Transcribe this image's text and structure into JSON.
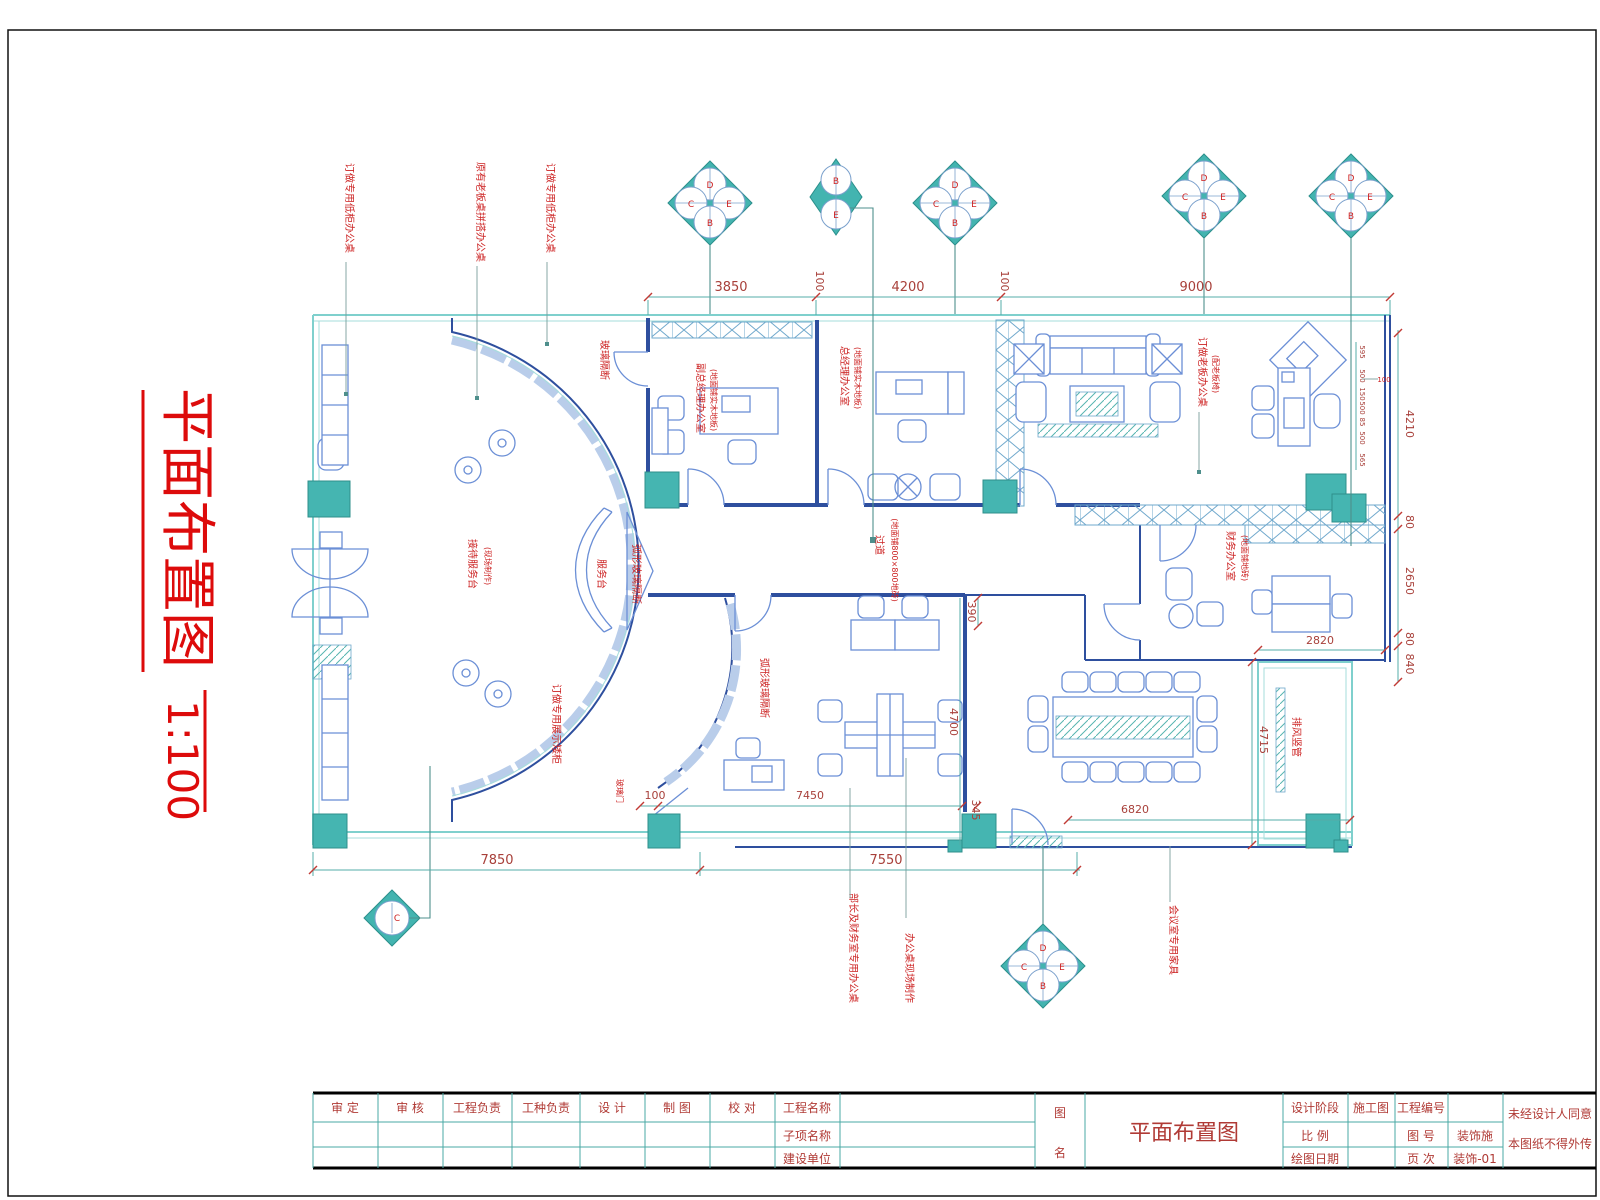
{
  "sheet": {
    "title": "平面布置图",
    "scale": "1:100"
  },
  "dims": {
    "top": [
      "3850",
      "100",
      "4200",
      "100",
      "9000"
    ],
    "right": [
      "4210",
      "80",
      "2650",
      "80",
      "840"
    ],
    "right_inner": {
      "w2820": "2820",
      "w4715": "4715"
    },
    "bottom": [
      "7850",
      "7550"
    ],
    "inner": {
      "d100": "100",
      "d7450": "7450",
      "d345": "345",
      "d390": "390",
      "d4700": "4700",
      "d6820": "6820"
    },
    "mini": [
      "595",
      "500",
      "150",
      "500",
      "85",
      "500",
      "565"
    ],
    "mini_red": "100"
  },
  "ann": {
    "left1": "订做专用低柜办公桌",
    "left2": "原有老板桌拼搭办公桌",
    "left3": "订做专用低柜办公桌",
    "glass": "玻璃隔断",
    "office1": "副总经理办公室",
    "office1b": "(地面铺实木地板)",
    "office2": "总经理办公室",
    "office2b": "(地面铺实木地板)",
    "boss": "订做老板办公桌",
    "boss_b": "(配老板椅)",
    "reception": "接待服务台",
    "reception_b": "(现场制作)",
    "counter": "服务台",
    "curved_glass": "弧形玻璃隔断",
    "corridor": "过道",
    "corridor_b": "(地面铺800×800地砖)",
    "finance": "财务办公室",
    "finance_b": "(地面铺地砖)",
    "arc_cabinet": "订做专用展示矮柜",
    "arc_glass": "弧形玻璃隔断",
    "exhaust": "排风竖管",
    "glass_door": "玻璃门",
    "bottom1": "部长及财务室专用办公桌",
    "bottom2": "办公桌现场制作",
    "bottom3": "会议室专用家具"
  },
  "markers": {
    "m1": [
      "D",
      "C",
      "E",
      "B"
    ],
    "m2": [
      "B",
      "E"
    ],
    "m3": [
      "D",
      "C",
      "E",
      "B"
    ],
    "m4": [
      "D",
      "C",
      "E",
      "B"
    ],
    "m5": [
      "D",
      "C",
      "E",
      "B"
    ],
    "m6": [
      "D",
      "C",
      "E",
      "B"
    ],
    "m7": [
      "C"
    ]
  },
  "titleblock": {
    "headers": [
      "审 定",
      "审 核",
      "工程负责",
      "工种负责",
      "设 计",
      "制 图",
      "校 对",
      "工程名称"
    ],
    "row2_label": "子项名称",
    "row3_label": "建设单位",
    "name_col": [
      "图",
      "名"
    ],
    "drawing_name": "平面布置图",
    "stage_label": "设计阶段",
    "stage_value": "施工图",
    "projno_label": "工程编号",
    "scale_label": "比 例",
    "figno_label": "图 号",
    "figno_value": "装饰施",
    "date_label": "绘图日期",
    "page_label": "页 次",
    "page_value": "装饰-01",
    "notice_line1": "未经设计人同意",
    "notice_line2": "本图纸不得外传"
  }
}
